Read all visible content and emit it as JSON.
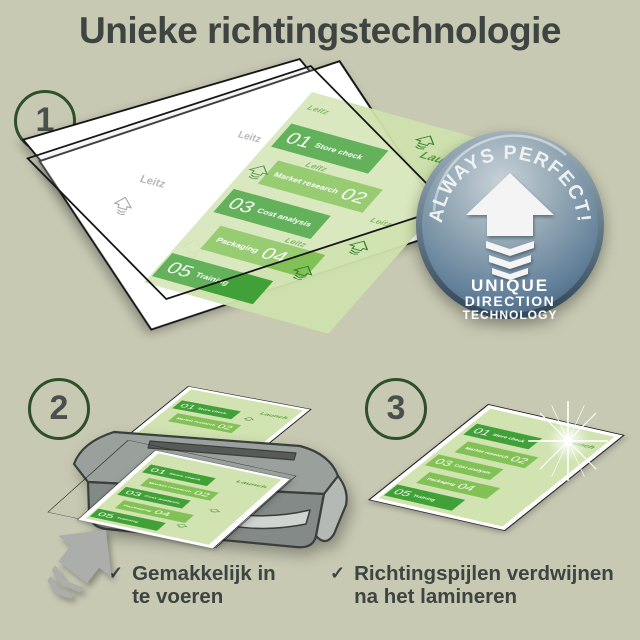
{
  "title": "Unieke richtingstechnologie",
  "steps": [
    {
      "number": "1"
    },
    {
      "number": "2"
    },
    {
      "number": "3"
    }
  ],
  "badge": {
    "arc_text": "ALWAYS PERFECT!",
    "line1": "UNIQUE",
    "line2": "DIRECTION",
    "line3": "TECHNOLOGY"
  },
  "doc": {
    "launch": "Launch",
    "watermark": "Leitz",
    "items": [
      {
        "number": "01",
        "label": "Store check"
      },
      {
        "number": "02",
        "label": "Market research"
      },
      {
        "number": "03",
        "label": "Cost analysis"
      },
      {
        "number": "04",
        "label": "Packaging"
      },
      {
        "number": "05",
        "label": "Training"
      }
    ]
  },
  "bullets": [
    {
      "mark": "✓",
      "line1": "Gemakkelijk in",
      "line2": "te voeren"
    },
    {
      "mark": "✓",
      "line1": "Richtingspijlen verdwijnen",
      "line2": "na het lamineren"
    }
  ],
  "colors": {
    "background": "#c7c9b3",
    "title_text": "#3d4441",
    "step_ring_green": "#2d4f2a",
    "doc_dark_green": "#41a037",
    "doc_mid_green": "#82c155",
    "doc_bg_green": "#cfe2ad",
    "badge_steel_light": "#c3ced6",
    "badge_steel_dark": "#3e586d",
    "machine_gray": "#8a908c",
    "arrow_gray": "#abaeab"
  }
}
